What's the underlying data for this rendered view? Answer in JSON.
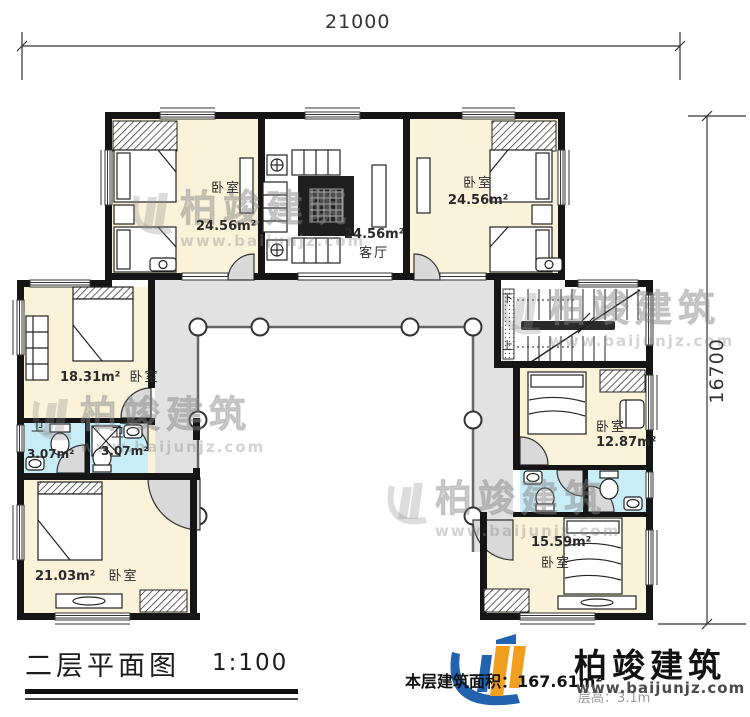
{
  "plan": {
    "dimensions": {
      "width": "21000",
      "height": "16700"
    },
    "rooms": [
      {
        "id": "bedroom-top-left",
        "name": "卧室",
        "area": "24.56m²"
      },
      {
        "id": "living-room",
        "name": "客厅",
        "area": "24.56m²"
      },
      {
        "id": "bedroom-top-right",
        "name": "卧室",
        "area": "24.56m²"
      },
      {
        "id": "bedroom-mid-left",
        "name": "卧室",
        "area": "18.31m²"
      },
      {
        "id": "bath-left-1",
        "name": "卫",
        "area": "3.07m²"
      },
      {
        "id": "bath-left-2",
        "name": "卫",
        "area": "3.07m²"
      },
      {
        "id": "bedroom-bottom-left",
        "name": "卧室",
        "area": "21.03m²"
      },
      {
        "id": "bedroom-mid-right",
        "name": "卧室",
        "area": "12.87m²"
      },
      {
        "id": "bedroom-bottom-right",
        "name": "卧室",
        "area": "15.59m²"
      }
    ],
    "stairs": {
      "down": "下",
      "up": "上"
    },
    "colors": {
      "wall": "#151515",
      "bedroom_fill": "#faf3d9",
      "bath_fill": "#c9edf7",
      "terrace_fill": "#e2e2e2",
      "brand_blue": "#2163ae",
      "brand_orange": "#f09f1f"
    }
  },
  "watermark": {
    "name": "柏竣建筑",
    "url": "www.baijunjz.com"
  },
  "footer": {
    "title": "二层平面图",
    "scale": "1:100",
    "area_label": "本层建筑面积：167.61m²",
    "floor_height": "层高：3.1m"
  },
  "brand": {
    "name": "柏竣建筑",
    "url": "www.baijunjz.com"
  }
}
